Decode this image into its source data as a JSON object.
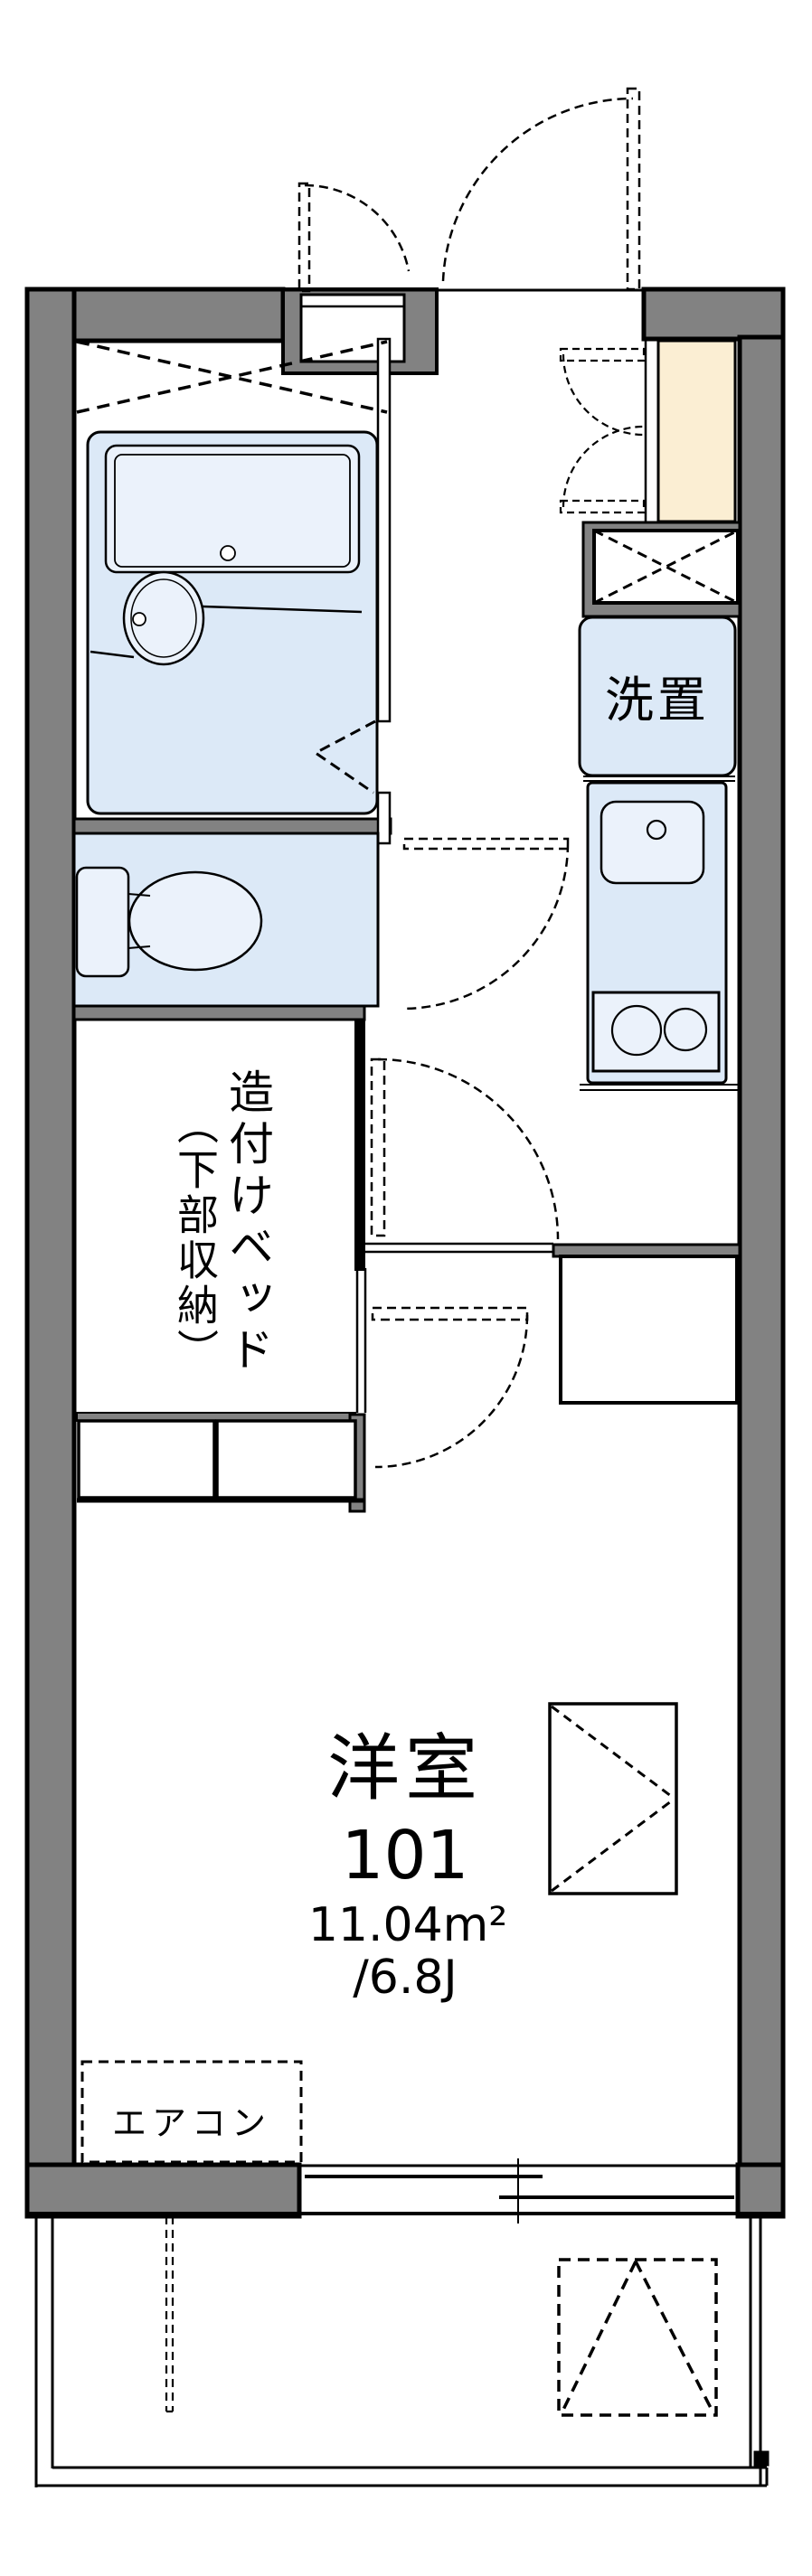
{
  "plan": {
    "labels": {
      "laundry": "洗置",
      "built_in_bed": "造付けベッド",
      "bed_sub": "（下部収納）",
      "aircon": "エアコン",
      "room_name": "洋室",
      "room_number": "101",
      "room_area_sqm": "11.04m²",
      "room_area_tatami": "/6.8J"
    },
    "colors": {
      "wall": "#828282",
      "unit": "#dce9f7",
      "fixture": "#ebf2fb",
      "genkan": "#fbeed3",
      "line": "#000000"
    }
  }
}
